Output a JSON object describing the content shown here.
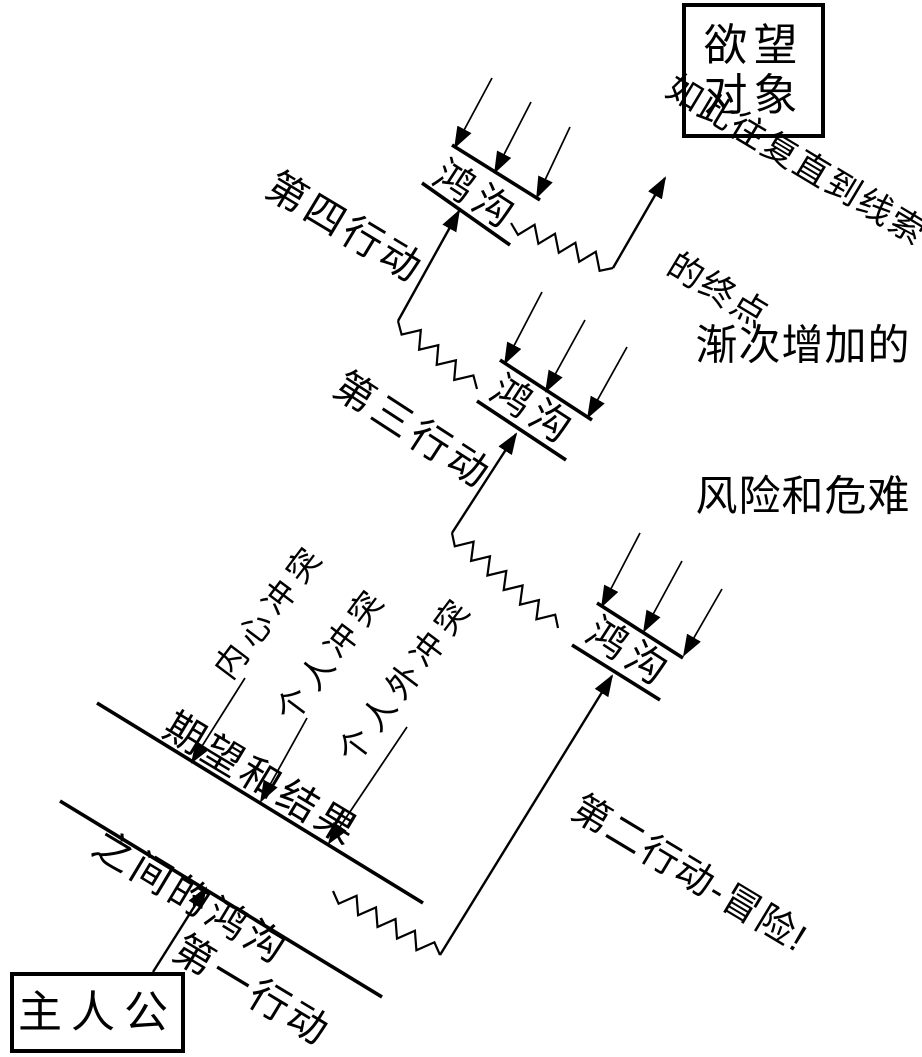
{
  "diagram": {
    "desire_object": {
      "line1": "欲望",
      "line2": "对象"
    },
    "protagonist": "主人公",
    "gap_labels": {
      "gap1": "鸿沟",
      "gap2": "鸿沟",
      "gap3": "鸿沟"
    },
    "expectation_gap": {
      "line1": "期望和结果",
      "line2": "之间的鸿沟"
    },
    "actions": {
      "first": "第一行动",
      "second": "第二行动-冒险!",
      "third": "第三行动",
      "fourth": "第四行动"
    },
    "conflicts": {
      "inner": "内心冲突",
      "personal": "个人冲突",
      "extrapersonal": "个人外冲突"
    },
    "annotations": {
      "repeat_line1": "如此往复直到线索",
      "repeat_line2": "的终点",
      "risk_line1": "渐次增加的",
      "risk_line2": "风险和危难"
    },
    "colors": {
      "ink": "#000000",
      "background": "#ffffff"
    }
  }
}
